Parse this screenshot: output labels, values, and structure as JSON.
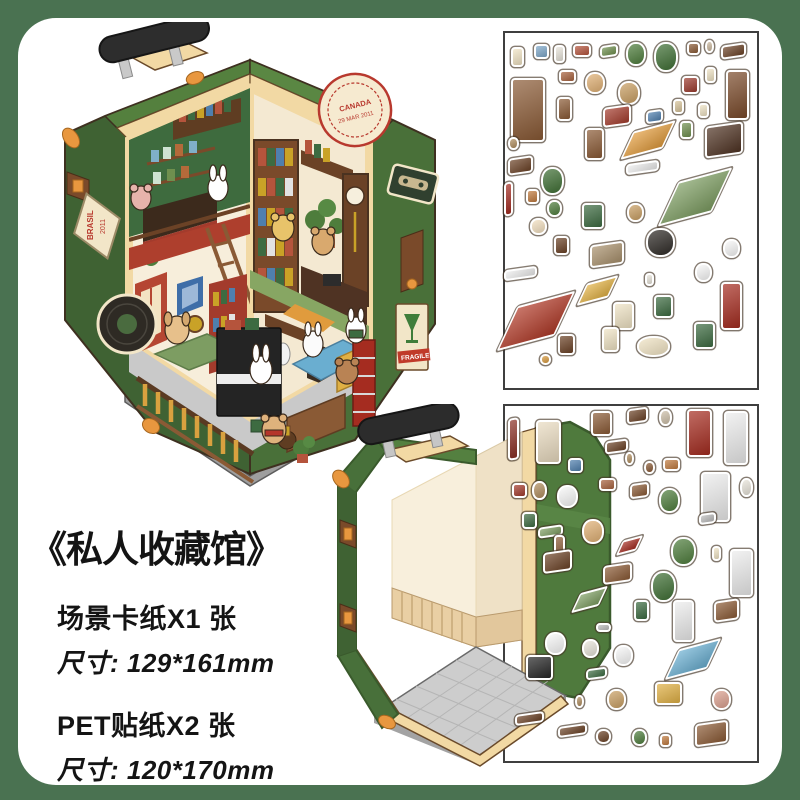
{
  "colors": {
    "outer_background": "#4a7251",
    "card_background": "#ffffff",
    "suitcase_green": "#507c3e",
    "suitcase_trim_cream": "#f2d9a4",
    "stamp_red": "#b8392e",
    "text_color": "#141414",
    "sheet_border": "#3f3f3f"
  },
  "title_block": {
    "title": "《私人收藏馆》",
    "spec1_label": "场景卡纸X1 张",
    "spec1_size": "尺寸: 129*161mm",
    "spec2_label": "PET贴纸X2 张",
    "spec2_size": "尺寸: 120*170mm"
  },
  "suitcase_diorama": {
    "stamps": {
      "canada": "CANADA",
      "canada_date": "29 MAR 2011",
      "brasil": "BRASIL",
      "brasil_year": "2011",
      "fragile": "FRAGILE"
    }
  },
  "sticker_sheets": [
    {
      "name": "pet-sticker-sheet-1",
      "items": [
        {
          "n": "tag-label",
          "x": 3,
          "y": 4.5,
          "w": 13,
          "h": 20,
          "c": "#f1e4c4",
          "s": "r"
        },
        {
          "n": "photo-frame",
          "x": 12,
          "y": 3.5,
          "w": 15,
          "h": 15,
          "c": "#7fa8c9",
          "s": "r"
        },
        {
          "n": "candle-lamp",
          "x": 20,
          "y": 4,
          "w": 11,
          "h": 18,
          "c": "#e8e4da",
          "s": "r"
        },
        {
          "n": "book-stack",
          "x": 27.5,
          "y": 3.5,
          "w": 18,
          "h": 13,
          "c": "#b5543c",
          "s": "r"
        },
        {
          "n": "green-case",
          "x": 38,
          "y": 4,
          "w": 18,
          "h": 12,
          "c": "#6f8f4e",
          "s": "i"
        },
        {
          "n": "hanging-plant",
          "x": 48,
          "y": 3,
          "w": 20,
          "h": 24,
          "c": "#4e7d3c",
          "s": "o"
        },
        {
          "n": "potted-palm",
          "x": 59,
          "y": 3,
          "w": 24,
          "h": 30,
          "c": "#3f6f34",
          "s": "o"
        },
        {
          "n": "barrel",
          "x": 72,
          "y": 3,
          "w": 13,
          "h": 13,
          "c": "#8a5a35",
          "s": "r"
        },
        {
          "n": "small-vase",
          "x": 79,
          "y": 2.5,
          "w": 9,
          "h": 13,
          "c": "#cbb89e",
          "s": "o"
        },
        {
          "n": "wall-shelf",
          "x": 85,
          "y": 3.5,
          "w": 25,
          "h": 14,
          "c": "#6b4226",
          "s": "i"
        },
        {
          "n": "tall-bookshelf",
          "x": 3,
          "y": 13,
          "w": 34,
          "h": 64,
          "c": "#8a5a35",
          "s": "r"
        },
        {
          "n": "mini-books",
          "x": 22,
          "y": 11,
          "w": 17,
          "h": 13,
          "c": "#a8623e",
          "s": "r"
        },
        {
          "n": "bear-lamp",
          "x": 32,
          "y": 11.5,
          "w": 20,
          "h": 22,
          "c": "#e0b074",
          "s": "o"
        },
        {
          "n": "bear-with-cup",
          "x": 45,
          "y": 14,
          "w": 22,
          "h": 24,
          "c": "#c99f63",
          "s": "o"
        },
        {
          "n": "red-books",
          "x": 70,
          "y": 12.5,
          "w": 17,
          "h": 18,
          "c": "#9c3b2e",
          "s": "r"
        },
        {
          "n": "paper-tag",
          "x": 79,
          "y": 10,
          "w": 11,
          "h": 16,
          "c": "#efe3c4",
          "s": "r"
        },
        {
          "n": "grandfather-clock",
          "x": 87,
          "y": 11,
          "w": 23,
          "h": 50,
          "c": "#7a4a2a",
          "s": "r"
        },
        {
          "n": "small-shelf",
          "x": 21,
          "y": 18.5,
          "w": 15,
          "h": 24,
          "c": "#8a5a35",
          "s": "r"
        },
        {
          "n": "red-bench-books",
          "x": 39,
          "y": 21,
          "w": 28,
          "h": 20,
          "c": "#a33b2c",
          "s": "i"
        },
        {
          "n": "blue-box",
          "x": 56,
          "y": 22,
          "w": 17,
          "h": 13,
          "c": "#4f7fae",
          "s": "i"
        },
        {
          "n": "beige-book",
          "x": 66.5,
          "y": 19,
          "w": 11,
          "h": 15,
          "c": "#d8c49a",
          "s": "r"
        },
        {
          "n": "paper-tag-2",
          "x": 76,
          "y": 20,
          "w": 11,
          "h": 15,
          "c": "#efe3c4",
          "s": "r"
        },
        {
          "n": "wood-ladder",
          "x": 32,
          "y": 27,
          "w": 19,
          "h": 32,
          "c": "#8a5a35",
          "s": "r"
        },
        {
          "n": "orange-rug",
          "x": 48,
          "y": 27,
          "w": 44,
          "h": 24,
          "c": "#e09b3d",
          "s": "f"
        },
        {
          "n": "green-bottle",
          "x": 69,
          "y": 25,
          "w": 13,
          "h": 18,
          "c": "#6f8f4e",
          "s": "r"
        },
        {
          "n": "dark-dresser",
          "x": 79,
          "y": 26,
          "w": 38,
          "h": 32,
          "c": "#4f3323",
          "s": "i"
        },
        {
          "n": "honey-jar",
          "x": 2,
          "y": 29.5,
          "w": 11,
          "h": 13,
          "c": "#b08d5e",
          "s": "o"
        },
        {
          "n": "sideboard",
          "x": 2,
          "y": 35,
          "w": 25,
          "h": 17,
          "c": "#6b4226",
          "s": "i"
        },
        {
          "n": "palm-plant-2",
          "x": 15,
          "y": 38,
          "w": 23,
          "h": 28,
          "c": "#3f6f34",
          "s": "o"
        },
        {
          "n": "red-pen",
          "x": 0.5,
          "y": 42,
          "w": 9,
          "h": 34,
          "c": "#a32b20",
          "s": "i"
        },
        {
          "n": "wood-frame",
          "x": 9,
          "y": 44,
          "w": 13,
          "h": 15,
          "c": "#c07a3e",
          "s": "r"
        },
        {
          "n": "potted-plant",
          "x": 17,
          "y": 47,
          "w": 15,
          "h": 17,
          "c": "#4e7d3c",
          "s": "o"
        },
        {
          "n": "bunny-sticker",
          "x": 10.5,
          "y": 52,
          "w": 17,
          "h": 17,
          "c": "#f3e0c0",
          "s": "o"
        },
        {
          "n": "green-cabinet",
          "x": 31,
          "y": 48,
          "w": 22,
          "h": 26,
          "c": "#3d6b41",
          "s": "r"
        },
        {
          "n": "gramophone",
          "x": 20,
          "y": 57,
          "w": 15,
          "h": 19,
          "c": "#6b4226",
          "s": "r"
        },
        {
          "n": "kitchen-counter",
          "x": 34,
          "y": 59,
          "w": 34,
          "h": 23,
          "c": "#a8906c",
          "s": "i"
        },
        {
          "n": "vinyl-record",
          "x": 56,
          "y": 55,
          "w": 29,
          "h": 29,
          "c": "#2e2a26",
          "s": "o"
        },
        {
          "n": "tan-bear",
          "x": 48.5,
          "y": 48,
          "w": 17,
          "h": 19,
          "c": "#c99f63",
          "s": "o"
        },
        {
          "n": "green-rug-large",
          "x": 64,
          "y": 41,
          "w": 56,
          "h": 38,
          "c": "#7d9d62",
          "s": "f"
        },
        {
          "n": "white-railing",
          "x": 48,
          "y": 36.5,
          "w": 33,
          "h": 11,
          "c": "#ececec",
          "s": "i"
        },
        {
          "n": "white-bunny",
          "x": 86,
          "y": 58,
          "w": 17,
          "h": 19,
          "c": "#f8f8f8",
          "s": "o"
        },
        {
          "n": "white-bunny-2",
          "x": 75,
          "y": 64.5,
          "w": 17,
          "h": 19,
          "c": "#f8f8f8",
          "s": "o"
        },
        {
          "n": "red-ladder-shelf",
          "x": 85,
          "y": 70,
          "w": 21,
          "h": 48,
          "c": "#a52c20",
          "s": "r"
        },
        {
          "n": "dartboard-sign",
          "x": 59,
          "y": 73.5,
          "w": 19,
          "h": 23,
          "c": "#3d6b41",
          "s": "r"
        },
        {
          "n": "brasil-stamp",
          "x": 43,
          "y": 75.5,
          "w": 21,
          "h": 28,
          "c": "#efe3c4",
          "s": "r"
        },
        {
          "n": "candle",
          "x": 55.5,
          "y": 67.5,
          "w": 9,
          "h": 13,
          "c": "#e8e4da",
          "s": "r"
        },
        {
          "n": "yellow-rug",
          "x": 30.5,
          "y": 69.5,
          "w": 33,
          "h": 19,
          "c": "#e0b044",
          "s": "f"
        },
        {
          "n": "red-rug-large",
          "x": 1,
          "y": 75.5,
          "w": 60,
          "h": 38,
          "c": "#b03a28",
          "s": "f"
        },
        {
          "n": "white-railing-2",
          "x": 0.5,
          "y": 66,
          "w": 33,
          "h": 11,
          "c": "#ececec",
          "s": "i"
        },
        {
          "n": "plant-table",
          "x": 21.5,
          "y": 84.5,
          "w": 17,
          "h": 21,
          "c": "#6b4226",
          "s": "r"
        },
        {
          "n": "pizza-slice",
          "x": 14.5,
          "y": 90,
          "w": 11,
          "h": 11,
          "c": "#d89a3e",
          "s": "o"
        },
        {
          "n": "glass-sign",
          "x": 38.5,
          "y": 82.5,
          "w": 17,
          "h": 25,
          "c": "#efe3c4",
          "s": "r"
        },
        {
          "n": "canada-stamp",
          "x": 52.5,
          "y": 85,
          "w": 33,
          "h": 21,
          "c": "#f1e4c4",
          "s": "o"
        },
        {
          "n": "green-pennant",
          "x": 74.5,
          "y": 81,
          "w": 21,
          "h": 27,
          "c": "#3d6b41",
          "s": "r"
        }
      ]
    },
    {
      "name": "pet-sticker-sheet-2",
      "items": [
        {
          "n": "curtain-rod",
          "x": 2,
          "y": 4,
          "w": 11,
          "h": 42,
          "c": "#8a2f24",
          "s": "i"
        },
        {
          "n": "arch-window",
          "x": 13,
          "y": 4.5,
          "w": 25,
          "h": 44,
          "c": "#e9dbc0",
          "s": "r"
        },
        {
          "n": "deer-head",
          "x": 34.5,
          "y": 2,
          "w": 21,
          "h": 25,
          "c": "#8a5a35",
          "s": "r"
        },
        {
          "n": "treasure-chest",
          "x": 48.5,
          "y": 1,
          "w": 21,
          "h": 15,
          "c": "#6b4226",
          "s": "i"
        },
        {
          "n": "potion-jar",
          "x": 61,
          "y": 1.5,
          "w": 13,
          "h": 17,
          "c": "#cdbfa8",
          "s": "o"
        },
        {
          "n": "red-door",
          "x": 72,
          "y": 1.5,
          "w": 25,
          "h": 48,
          "c": "#a52c20",
          "s": "r"
        },
        {
          "n": "clothes-rack",
          "x": 86.5,
          "y": 2,
          "w": 24,
          "h": 54,
          "c": "#ececec",
          "s": "r"
        },
        {
          "n": "wall-shelf-2",
          "x": 40,
          "y": 10,
          "w": 23,
          "h": 13,
          "c": "#6b4226",
          "s": "i"
        },
        {
          "n": "lantern",
          "x": 47.5,
          "y": 13.5,
          "w": 9,
          "h": 13,
          "c": "#b08d5e",
          "s": "o"
        },
        {
          "n": "blue-frame",
          "x": 25.5,
          "y": 15,
          "w": 15,
          "h": 15,
          "c": "#4f7fae",
          "s": "r"
        },
        {
          "n": "clay-jar",
          "x": 55,
          "y": 16,
          "w": 11,
          "h": 13,
          "c": "#8a5a35",
          "s": "o"
        },
        {
          "n": "small-frames",
          "x": 62.5,
          "y": 15,
          "w": 17,
          "h": 13,
          "c": "#c07a3e",
          "s": "r"
        },
        {
          "n": "globe",
          "x": 11.5,
          "y": 21.5,
          "w": 15,
          "h": 19,
          "c": "#b08d5e",
          "s": "o"
        },
        {
          "n": "white-cat",
          "x": 21,
          "y": 22.5,
          "w": 21,
          "h": 23,
          "c": "#f8f8f8",
          "s": "o"
        },
        {
          "n": "gift-boxes",
          "x": 3.5,
          "y": 22,
          "w": 15,
          "h": 15,
          "c": "#a33b2c",
          "s": "r"
        },
        {
          "n": "book-pile",
          "x": 37.5,
          "y": 20.5,
          "w": 17,
          "h": 13,
          "c": "#a8623e",
          "s": "r"
        },
        {
          "n": "shelf-items",
          "x": 49.5,
          "y": 22,
          "w": 19,
          "h": 15,
          "c": "#8a5a35",
          "s": "i"
        },
        {
          "n": "plant-pot-2",
          "x": 61,
          "y": 23.5,
          "w": 21,
          "h": 25,
          "c": "#4e7d3c",
          "s": "o"
        },
        {
          "n": "wardrobe-rack",
          "x": 77.5,
          "y": 19,
          "w": 29,
          "h": 50,
          "c": "#ececec",
          "s": "r"
        },
        {
          "n": "white-vase",
          "x": 92.5,
          "y": 20.5,
          "w": 13,
          "h": 19,
          "c": "#e8e4da",
          "s": "o"
        },
        {
          "n": "gray-box",
          "x": 76.5,
          "y": 30.5,
          "w": 17,
          "h": 11,
          "c": "#bbbbbb",
          "s": "i"
        },
        {
          "n": "green-ledger",
          "x": 7.5,
          "y": 30,
          "w": 15,
          "h": 17,
          "c": "#3d6b41",
          "s": "r"
        },
        {
          "n": "keyboard-strip",
          "x": 13.5,
          "y": 34,
          "w": 25,
          "h": 11,
          "c": "#7d9d62",
          "s": "i"
        },
        {
          "n": "bear-with-book",
          "x": 31,
          "y": 32,
          "w": 22,
          "h": 25,
          "c": "#e0b074",
          "s": "o"
        },
        {
          "n": "violin",
          "x": 20,
          "y": 36.5,
          "w": 11,
          "h": 27,
          "c": "#8a5a35",
          "s": "r"
        },
        {
          "n": "red-mat",
          "x": 45.5,
          "y": 37.5,
          "w": 21,
          "h": 13,
          "c": "#a32b20",
          "s": "f"
        },
        {
          "n": "monstera-plant",
          "x": 65.5,
          "y": 37,
          "w": 25,
          "h": 29,
          "c": "#4e7d3c",
          "s": "o"
        },
        {
          "n": "paper-tag-3",
          "x": 81.5,
          "y": 39.5,
          "w": 9,
          "h": 15,
          "c": "#efe3c4",
          "s": "r"
        },
        {
          "n": "clothes-rack-2",
          "x": 88.5,
          "y": 40.5,
          "w": 23,
          "h": 48,
          "c": "#ececec",
          "s": "r"
        },
        {
          "n": "low-dresser",
          "x": 15.5,
          "y": 41,
          "w": 29,
          "h": 21,
          "c": "#6b4226",
          "s": "i"
        },
        {
          "n": "display-shelf",
          "x": 39,
          "y": 44.5,
          "w": 29,
          "h": 19,
          "c": "#8a5a35",
          "s": "i"
        },
        {
          "n": "potted-tree",
          "x": 58,
          "y": 46.5,
          "w": 25,
          "h": 31,
          "c": "#3f6f34",
          "s": "o"
        },
        {
          "n": "green-mat",
          "x": 28,
          "y": 52,
          "w": 29,
          "h": 17,
          "c": "#7d9d62",
          "s": "f"
        },
        {
          "n": "green-stool",
          "x": 51,
          "y": 54.5,
          "w": 15,
          "h": 21,
          "c": "#3d6b41",
          "s": "r"
        },
        {
          "n": "door-frame",
          "x": 66.5,
          "y": 54.5,
          "w": 21,
          "h": 42,
          "c": "#ececec",
          "s": "r"
        },
        {
          "n": "dresser-3",
          "x": 82.5,
          "y": 54.5,
          "w": 25,
          "h": 21,
          "c": "#8a5a35",
          "s": "i"
        },
        {
          "n": "gray-books",
          "x": 36.5,
          "y": 61,
          "w": 15,
          "h": 9,
          "c": "#bbbbbb",
          "s": "r"
        },
        {
          "n": "white-cat-2",
          "x": 16.5,
          "y": 63.5,
          "w": 21,
          "h": 23,
          "c": "#f8f8f8",
          "s": "o"
        },
        {
          "n": "sunflower-bear",
          "x": 31,
          "y": 65.5,
          "w": 17,
          "h": 19,
          "c": "#e8e4da",
          "s": "o"
        },
        {
          "n": "panda-sticker",
          "x": 43.5,
          "y": 67,
          "w": 19,
          "h": 21,
          "c": "#f8f8f8",
          "s": "o"
        },
        {
          "n": "blue-rug",
          "x": 65.5,
          "y": 67.5,
          "w": 44,
          "h": 26,
          "c": "#6aaed0",
          "s": "f"
        },
        {
          "n": "upright-piano",
          "x": 9,
          "y": 70,
          "w": 27,
          "h": 25,
          "c": "#262626",
          "s": "r"
        },
        {
          "n": "green-bench",
          "x": 32.5,
          "y": 73.5,
          "w": 21,
          "h": 11,
          "c": "#3d6b41",
          "s": "i"
        },
        {
          "n": "hourglass",
          "x": 28,
          "y": 81,
          "w": 9,
          "h": 13,
          "c": "#b08d5e",
          "s": "o"
        },
        {
          "n": "scarf-bear",
          "x": 40.5,
          "y": 79.5,
          "w": 19,
          "h": 21,
          "c": "#c99f63",
          "s": "o"
        },
        {
          "n": "yellow-armchair",
          "x": 59.5,
          "y": 77.5,
          "w": 27,
          "h": 23,
          "c": "#e0b044",
          "s": "r"
        },
        {
          "n": "pink-bear",
          "x": 81.5,
          "y": 79.5,
          "w": 19,
          "h": 21,
          "c": "#dba08f",
          "s": "o"
        },
        {
          "n": "stair-railing",
          "x": 4.5,
          "y": 86,
          "w": 29,
          "h": 11,
          "c": "#6b4226",
          "s": "i"
        },
        {
          "n": "stair-railing-2",
          "x": 21.5,
          "y": 89.5,
          "w": 29,
          "h": 11,
          "c": "#6b4226",
          "s": "i"
        },
        {
          "n": "round-table",
          "x": 36.5,
          "y": 90.5,
          "w": 15,
          "h": 15,
          "c": "#6b4226",
          "s": "o"
        },
        {
          "n": "potted-plant-3",
          "x": 50.5,
          "y": 90.5,
          "w": 15,
          "h": 17,
          "c": "#4e7d3c",
          "s": "o"
        },
        {
          "n": "small-frame",
          "x": 61.5,
          "y": 92,
          "w": 11,
          "h": 13,
          "c": "#c07a3e",
          "s": "r"
        },
        {
          "n": "brown-sofa",
          "x": 75,
          "y": 88.5,
          "w": 33,
          "h": 23,
          "c": "#8a5a35",
          "s": "i"
        }
      ]
    }
  ]
}
